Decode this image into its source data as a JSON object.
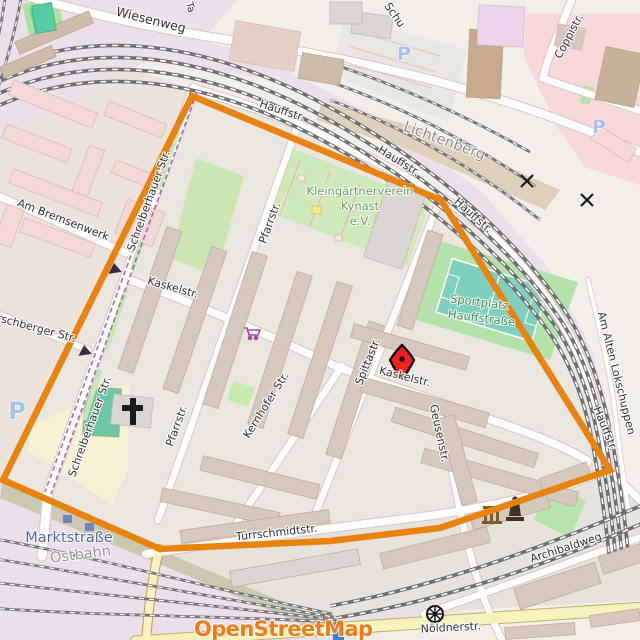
{
  "map": {
    "description": "OpenStreetMap extract with boundary polygon and marker",
    "attribution": "OpenStreetMap",
    "station_names": [
      "Lichtenberg",
      "Marktstraße",
      "Ostbahn"
    ],
    "area_names": [
      "Kleingärtnerverein Kynast e.V.",
      "Sportplatz Hauffstraße"
    ],
    "street_names": [
      "Wiesenweg",
      "Hauffstr.",
      "Coppistr.",
      "Am Bremsenwerk",
      "Schreiberhauer Str.",
      "Hirschberger Str.",
      "Pfarrstr.",
      "Kernhofer Str.",
      "Spittastr.",
      "Geusenstr.",
      "Kaskelstr.",
      "Türrschmidtstr.",
      "Archibaldweg",
      "Nöldnerstr.",
      "Am Alten Lokschuppen"
    ],
    "icons": [
      {
        "name": "parking-icon",
        "glyph": "P",
        "color": "#A9C2EC"
      },
      {
        "name": "church-cross-icon",
        "color": "#1A1A1A"
      },
      {
        "name": "supermarket-cart-icon",
        "color": "#A348A3"
      },
      {
        "name": "monument-columns-icon",
        "color": "#7A5A2E"
      },
      {
        "name": "statue-icon",
        "color": "#3E3226"
      },
      {
        "name": "wheel-icon",
        "color": "#111111"
      },
      {
        "name": "railway-crossing-icon",
        "glyph": "x",
        "color": "#1A1A1A"
      },
      {
        "name": "tram-direction-arrow",
        "color": "#3A2A4A"
      },
      {
        "name": "platform-marker",
        "color": "#6F83C4"
      }
    ],
    "labels": [
      {
        "name": "street-label-wiesenweg",
        "text": "Wiesenweg",
        "x": 150,
        "y": 24,
        "r": 14,
        "s": 12.5
      },
      {
        "name": "street-label-hauffstr-1",
        "text": "Hauffstr.",
        "x": 281,
        "y": 114,
        "r": 18
      },
      {
        "name": "street-label-hauffstr-2",
        "text": "Hauffstr.",
        "x": 397,
        "y": 164,
        "r": 32
      },
      {
        "name": "street-label-hauffstr-3",
        "text": "Hauffstr.",
        "x": 471,
        "y": 218,
        "r": 42
      },
      {
        "name": "street-label-hauffstr-4",
        "text": "Hauffstr.",
        "x": 602,
        "y": 430,
        "r": 68
      },
      {
        "name": "street-label-coppistr",
        "text": "Coppistr.",
        "x": 572,
        "y": 38,
        "r": -62
      },
      {
        "name": "street-label-partial-schu",
        "text": "Schu",
        "x": 384,
        "y": 6,
        "r": 55,
        "a": "start"
      },
      {
        "name": "street-label-partial-ta",
        "text": "Ta",
        "x": 186,
        "y": 3,
        "r": 75,
        "a": "start",
        "s": 10
      },
      {
        "name": "station-label-lichtenberg",
        "text": "Lichtenberg",
        "x": 443,
        "y": 145,
        "r": 20,
        "s": 14.5,
        "c": "#8C8C8C",
        "h": 2
      },
      {
        "name": "street-label-am-bremsenwerk",
        "text": "Am Bremsenwerk",
        "x": 62,
        "y": 223,
        "r": 21
      },
      {
        "name": "street-label-schreiberhauer-1",
        "text": "Schreiberhauer Str.",
        "x": 152,
        "y": 202,
        "r": -70
      },
      {
        "name": "street-label-schreiberhauer-2",
        "text": "Schreiberhauer Str.",
        "x": 93,
        "y": 428,
        "r": -70
      },
      {
        "name": "street-label-hirschberger",
        "text": "Hirschberger Str.",
        "x": 30,
        "y": 330,
        "r": 15
      },
      {
        "name": "street-label-pfarrstr-1",
        "text": "Pfarrstr.",
        "x": 273,
        "y": 224,
        "r": -70
      },
      {
        "name": "street-label-pfarrstr-2",
        "text": "Pfarrstr.",
        "x": 180,
        "y": 427,
        "r": -70
      },
      {
        "name": "street-label-kernhofer",
        "text": "Kernhofer Str.",
        "x": 269,
        "y": 407,
        "r": -58
      },
      {
        "name": "street-label-spittastr",
        "text": "Spittastr.",
        "x": 371,
        "y": 363,
        "r": -68
      },
      {
        "name": "street-label-geusenstr",
        "text": "Geusenstr.",
        "x": 436,
        "y": 434,
        "r": 78
      },
      {
        "name": "street-label-kaskelstr-1",
        "text": "Kaskelstr.",
        "x": 172,
        "y": 291,
        "r": 16
      },
      {
        "name": "street-label-kaskelstr-2",
        "text": "Kaskelstr.",
        "x": 404,
        "y": 380,
        "r": 14
      },
      {
        "name": "area-label-kleingarten-1",
        "text": "Kleingärtnerverein",
        "x": 360,
        "y": 195,
        "s": 11.5,
        "c": "#6D9B62",
        "h": 2
      },
      {
        "name": "area-label-kleingarten-2",
        "text": "Kynast",
        "x": 360,
        "y": 210,
        "s": 11.5,
        "c": "#6D9B62",
        "h": 2
      },
      {
        "name": "area-label-kleingarten-3",
        "text": "e.V.",
        "x": 360,
        "y": 225,
        "s": 11.5,
        "c": "#6D9B62",
        "h": 2
      },
      {
        "name": "area-label-sportplatz-1",
        "text": "Sportplatz",
        "x": 479,
        "y": 306,
        "r": 7,
        "s": 11.5,
        "c": "#4C8A5C",
        "h": 2
      },
      {
        "name": "area-label-sportplatz-2",
        "text": "Hauffstraße",
        "x": 481,
        "y": 322,
        "r": 7,
        "s": 11.5,
        "c": "#4C8A5C",
        "h": 2
      },
      {
        "name": "street-label-tuerrschmidtstr",
        "text": "Türrschmidtstr.",
        "x": 277,
        "y": 536,
        "r": -6
      },
      {
        "name": "station-label-marktstrasse",
        "text": "Marktstraße",
        "x": 69,
        "y": 542,
        "s": 14.5,
        "c": "#5066B2",
        "h": 2.2
      },
      {
        "name": "station-label-ostbahn",
        "text": "Ostbahn",
        "x": 81,
        "y": 559,
        "r": -7,
        "s": 14.5,
        "c": "#969696",
        "h": 2
      },
      {
        "name": "street-label-archibaldweg",
        "text": "Archibaldweg",
        "x": 567,
        "y": 551,
        "r": -18
      },
      {
        "name": "street-label-noeldnerstr",
        "text": "Nöldnerstr.",
        "x": 451,
        "y": 631,
        "r": -3
      },
      {
        "name": "street-label-am-alten-lokschuppen",
        "text": "Am Alten Lokschuppen",
        "x": 613,
        "y": 374,
        "r": 76
      },
      {
        "name": "parking-icon",
        "text": "P",
        "x": 17,
        "y": 419,
        "s": 24,
        "c": "#A9C2EC",
        "w": 600,
        "h": 1.5
      },
      {
        "name": "parking-icon",
        "text": "P",
        "x": 404,
        "y": 60,
        "s": 19,
        "c": "#A9C2EC",
        "w": 600,
        "h": 1.5
      },
      {
        "name": "parking-icon",
        "text": "P",
        "x": 599,
        "y": 133,
        "s": 19,
        "c": "#A9C2EC",
        "w": 600,
        "h": 1.5
      },
      {
        "name": "osm-attribution-wordmark",
        "text": "OpenStreetMap",
        "x": 194,
        "y": 636,
        "s": 21,
        "c": "#EE7D18",
        "w": 700,
        "a": "start",
        "h": 2,
        "ls": -0.6
      }
    ]
  },
  "boundary": {
    "name": "highlighted-area-outline",
    "color": "#E8830F",
    "points": "192,96 441,200 610,470 440,528 330,541 160,549 3,480"
  },
  "marker": {
    "name": "map-marker",
    "x": 402,
    "y": 361,
    "fill": "#F32020",
    "outline": "#140000"
  },
  "colors": {
    "land": "#F2EFE9",
    "railway_land": "#EBDFEA",
    "residential": "#EAE6E0",
    "retail_pink": "#F6D9D8",
    "building": "#D5C8BD",
    "building_pink": "#F2D9D6",
    "building_tan": "#CDBCA9",
    "allotment_green": "#CFE8BC",
    "sport_grass": "#B4E2AB",
    "pitch_teal": "#7ED0BC",
    "sand_yellow": "#F5F1D2",
    "secondary_road_yellow": "#F5F2BC",
    "track_grey": "#6F6F6F",
    "tram_purple": "#A66BB5"
  }
}
